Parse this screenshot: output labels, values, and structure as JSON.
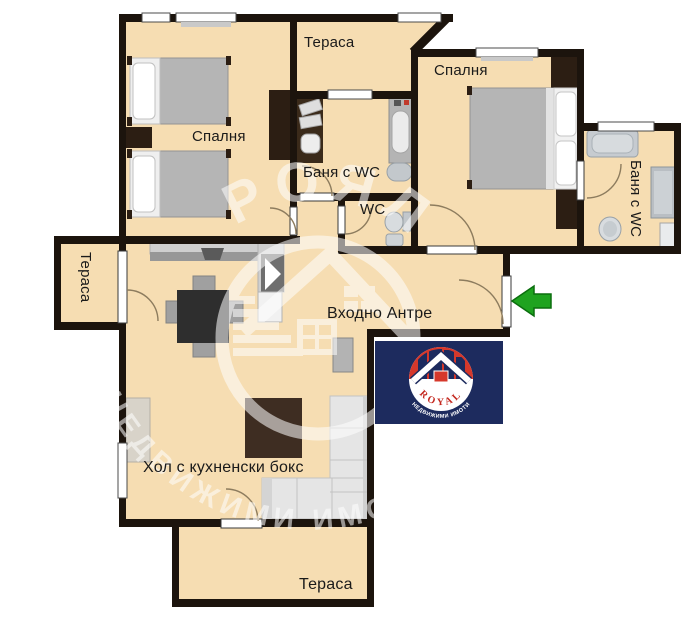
{
  "page": {
    "type": "apartment-floor-plan",
    "language": "bg"
  },
  "rooms": [
    {
      "id": "terrace-top",
      "label": "Тераса"
    },
    {
      "id": "bedroom-left",
      "label": "Спалня"
    },
    {
      "id": "bedroom-right",
      "label": "Спалня"
    },
    {
      "id": "bathroom-center",
      "label": "Баня с WC"
    },
    {
      "id": "wc",
      "label": "WC"
    },
    {
      "id": "bathroom-right",
      "label": "Баня с WC"
    },
    {
      "id": "terrace-left",
      "label": "Тераса"
    },
    {
      "id": "entry-hall",
      "label": "Входно Антре"
    },
    {
      "id": "living-room",
      "label": "Хол с кухненски бокс"
    },
    {
      "id": "terrace-bottom",
      "label": "Тераса"
    }
  ],
  "watermark": {
    "title": "РОЯЛ",
    "subtitle": "НЕДВИЖИМИ ИМОТИ"
  },
  "logo": {
    "name": "ROYAL",
    "subtitle": "НЕДВИЖИМИ ИМОТИ"
  },
  "entrance_arrow": {
    "direction": "left"
  },
  "colors": {
    "floor": "#f6ddb2",
    "wall": "#1c140d",
    "outside": "#ffffff",
    "logo-navy": "#1d2b5e",
    "logo-red": "#d6382b",
    "arrow-green": "#1fa31f",
    "label": "#1a1a1a"
  }
}
